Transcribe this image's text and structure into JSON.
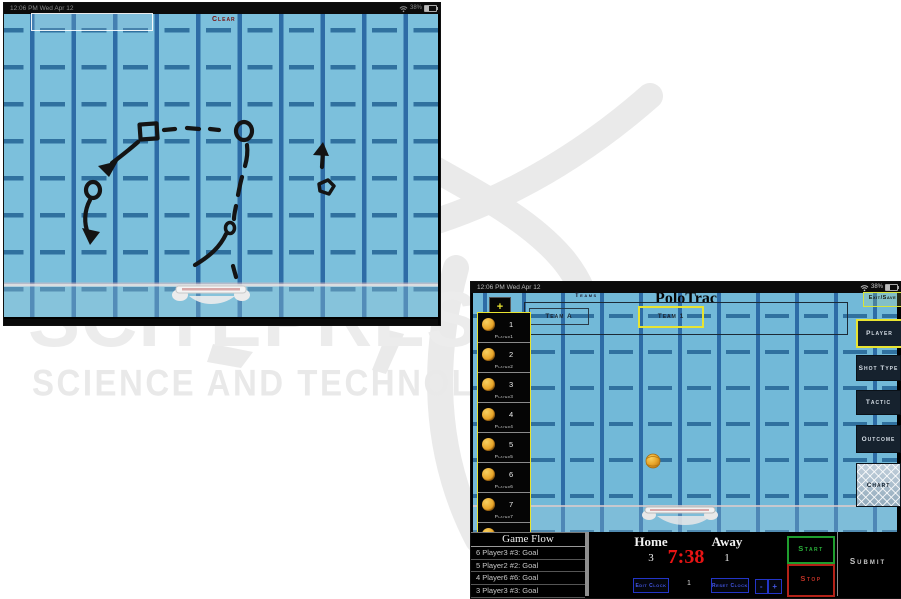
{
  "watermark": {
    "big_text": "SCITEPRESS",
    "tagline": "SCIENCE AND TECHNOLOGY PUBLICATIONS"
  },
  "sketch_screen": {
    "statusbar": {
      "left": "12:06 PM  Wed Apr 12",
      "battery": "38%"
    },
    "clear_button": "Clear"
  },
  "app_screen": {
    "statusbar": {
      "left": "12:06 PM  Wed Apr 12",
      "battery": "38%"
    },
    "header": {
      "add_button": "+",
      "teams_label": "Teams",
      "title": "PoloTrac",
      "exit_save_button": "Exit/Save"
    },
    "team_tabs": [
      {
        "label": "Team A",
        "selected": false
      },
      {
        "label": "Team 1",
        "selected": true
      }
    ],
    "players": [
      {
        "number": "1",
        "label": "Player1"
      },
      {
        "number": "2",
        "label": "Player2"
      },
      {
        "number": "3",
        "label": "Player3"
      },
      {
        "number": "4",
        "label": "Player4"
      },
      {
        "number": "5",
        "label": "Player5"
      },
      {
        "number": "6",
        "label": "Player6"
      },
      {
        "number": "7",
        "label": "Player7"
      },
      {
        "number": "8",
        "label": "Player8"
      }
    ],
    "right_menu": [
      {
        "label": "Player",
        "selected": true
      },
      {
        "label": "Shot Type",
        "selected": false
      },
      {
        "label": "Tactic",
        "selected": false
      },
      {
        "label": "Outcome",
        "selected": false
      },
      {
        "label": "Chart",
        "selected": false
      }
    ],
    "game_flow": {
      "title": "Game Flow",
      "events": [
        "6 Player3 #3: Goal",
        "5 Player2 #2: Goal",
        "4 Player6 #6: Goal",
        "3 Player3 #3: Goal"
      ]
    },
    "scoreboard": {
      "home_label": "Home",
      "home_score": "3",
      "clock": "7:38",
      "away_label": "Away",
      "away_score": "1",
      "edit_clock_button": "Edit Clock",
      "period": "1",
      "reset_clock_button": "Reset Clock",
      "minus_button": "-",
      "plus_button": "+"
    },
    "controls": {
      "start_button": "Start",
      "stop_button": "Stop",
      "submit_button": "Submit"
    }
  },
  "colors": {
    "pool_light": "#7cc0dc",
    "pool_app": "#72b9d8",
    "lane_line": "#2d6ca6",
    "highlight_yellow": "#e8e431",
    "clock_red": "#e81414",
    "start_green": "#1f9e2e",
    "stop_red": "#b32218",
    "button_blue": "#2335c8"
  }
}
